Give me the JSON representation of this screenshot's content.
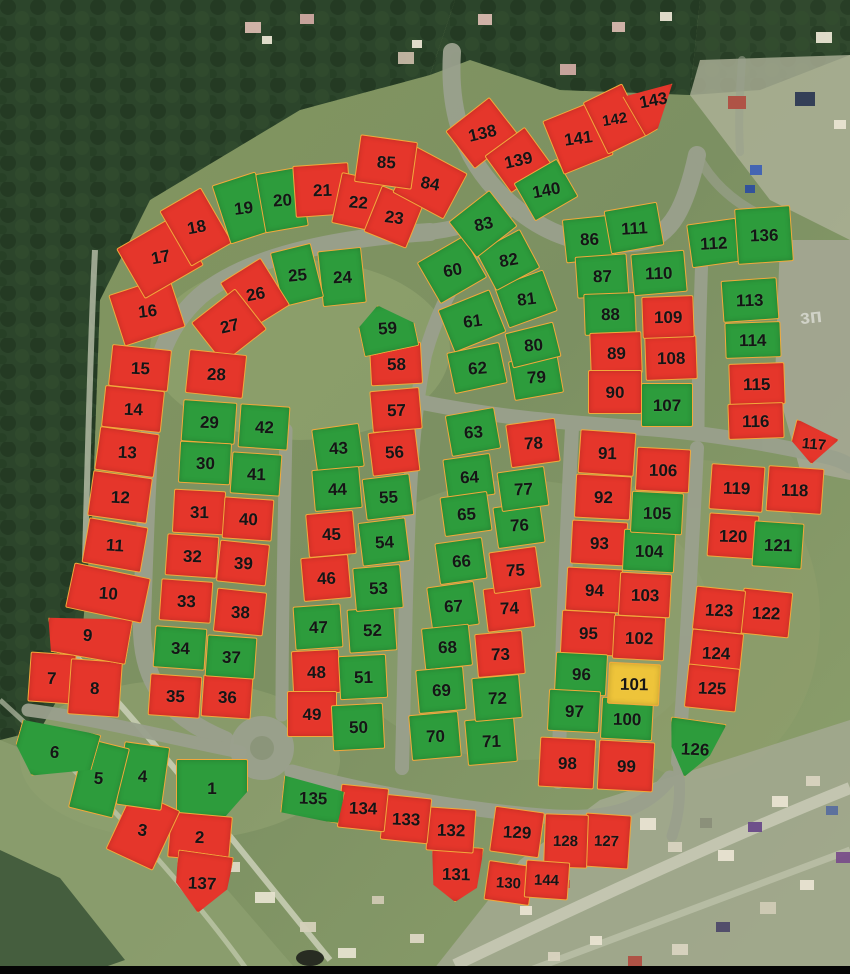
{
  "map": {
    "title": "land-plot-availability-map",
    "colors": {
      "available": "#2d9c3c",
      "sold": "#e5362b",
      "reserved": "#eec43a",
      "plot_border": "#f2a93b",
      "number_text": "#151515"
    },
    "status_codes": {
      "a": "available",
      "s": "sold",
      "v": "reserved"
    },
    "plot_fields": [
      "number",
      "cx",
      "cy",
      "w",
      "h",
      "rotation_deg",
      "status",
      "shape"
    ],
    "background_label": "зп",
    "plots": [
      [
        "1",
        212,
        788,
        72,
        58,
        0,
        "a",
        "s1"
      ],
      [
        "2",
        200,
        837,
        62,
        46,
        5,
        "s",
        ""
      ],
      [
        "3",
        143,
        830,
        52,
        66,
        25,
        "s",
        ""
      ],
      [
        "4",
        143,
        776,
        46,
        64,
        8,
        "a",
        ""
      ],
      [
        "5",
        99,
        778,
        46,
        72,
        14,
        "a",
        ""
      ],
      [
        "6",
        55,
        752,
        80,
        58,
        16,
        "a",
        "s6"
      ],
      [
        "7",
        52,
        678,
        46,
        50,
        4,
        "s",
        ""
      ],
      [
        "8",
        95,
        688,
        52,
        56,
        4,
        "s",
        ""
      ],
      [
        "9",
        88,
        635,
        84,
        46,
        10,
        "s",
        "s9"
      ],
      [
        "10",
        108,
        593,
        78,
        46,
        12,
        "s",
        ""
      ],
      [
        "11",
        115,
        545,
        60,
        46,
        10,
        "s",
        ""
      ],
      [
        "12",
        120,
        497,
        60,
        46,
        8,
        "s",
        ""
      ],
      [
        "13",
        127,
        452,
        60,
        44,
        8,
        "s",
        ""
      ],
      [
        "14",
        133,
        409,
        60,
        42,
        6,
        "s",
        ""
      ],
      [
        "15",
        140,
        368,
        60,
        42,
        6,
        "s",
        ""
      ],
      [
        "16",
        147,
        311,
        64,
        54,
        -18,
        "s",
        ""
      ],
      [
        "17",
        160,
        257,
        68,
        58,
        -30,
        "s",
        ""
      ],
      [
        "18",
        196,
        227,
        48,
        64,
        -30,
        "s",
        ""
      ],
      [
        "19",
        243,
        208,
        46,
        62,
        -18,
        "a",
        ""
      ],
      [
        "20",
        282,
        200,
        44,
        60,
        -10,
        "a",
        ""
      ],
      [
        "21",
        322,
        190,
        56,
        52,
        -4,
        "s",
        ""
      ],
      [
        "22",
        358,
        202,
        44,
        52,
        12,
        "s",
        ""
      ],
      [
        "23",
        394,
        217,
        46,
        50,
        22,
        "s",
        ""
      ],
      [
        "24",
        342,
        277,
        44,
        56,
        -6,
        "a",
        ""
      ],
      [
        "25",
        297,
        275,
        42,
        56,
        -14,
        "a",
        ""
      ],
      [
        "26",
        255,
        294,
        48,
        56,
        -32,
        "s",
        ""
      ],
      [
        "27",
        229,
        326,
        56,
        52,
        -38,
        "s",
        ""
      ],
      [
        "28",
        216,
        374,
        58,
        44,
        6,
        "s",
        ""
      ],
      [
        "29",
        209,
        422,
        54,
        42,
        4,
        "a",
        ""
      ],
      [
        "30",
        205,
        463,
        52,
        42,
        3,
        "a",
        ""
      ],
      [
        "31",
        199,
        512,
        52,
        44,
        3,
        "s",
        ""
      ],
      [
        "32",
        192,
        556,
        52,
        42,
        4,
        "s",
        ""
      ],
      [
        "33",
        186,
        601,
        52,
        42,
        4,
        "s",
        ""
      ],
      [
        "34",
        180,
        648,
        52,
        42,
        4,
        "a",
        ""
      ],
      [
        "35",
        175,
        696,
        52,
        42,
        4,
        "s",
        ""
      ],
      [
        "36",
        227,
        697,
        50,
        42,
        4,
        "s",
        ""
      ],
      [
        "37",
        231,
        657,
        50,
        42,
        4,
        "a",
        ""
      ],
      [
        "38",
        240,
        612,
        50,
        44,
        6,
        "s",
        ""
      ],
      [
        "39",
        243,
        563,
        50,
        42,
        6,
        "s",
        ""
      ],
      [
        "40",
        248,
        519,
        50,
        42,
        4,
        "s",
        ""
      ],
      [
        "41",
        256,
        474,
        50,
        42,
        4,
        "a",
        ""
      ],
      [
        "42",
        264,
        427,
        50,
        44,
        4,
        "a",
        ""
      ],
      [
        "43",
        338,
        448,
        48,
        44,
        -8,
        "a",
        ""
      ],
      [
        "44",
        337,
        489,
        48,
        42,
        -5,
        "a",
        ""
      ],
      [
        "45",
        331,
        534,
        48,
        44,
        -5,
        "s",
        ""
      ],
      [
        "46",
        326,
        578,
        48,
        44,
        -5,
        "s",
        ""
      ],
      [
        "47",
        318,
        627,
        48,
        44,
        -4,
        "a",
        ""
      ],
      [
        "48",
        316,
        672,
        48,
        44,
        -3,
        "s",
        ""
      ],
      [
        "49",
        312,
        714,
        50,
        46,
        0,
        "s",
        ""
      ],
      [
        "50",
        358,
        727,
        52,
        46,
        -3,
        "a",
        ""
      ],
      [
        "51",
        363,
        677,
        48,
        44,
        -3,
        "a",
        ""
      ],
      [
        "52",
        372,
        630,
        48,
        44,
        -4,
        "a",
        ""
      ],
      [
        "53",
        378,
        588,
        48,
        44,
        -5,
        "a",
        ""
      ],
      [
        "54",
        384,
        542,
        48,
        44,
        -7,
        "a",
        ""
      ],
      [
        "55",
        388,
        497,
        48,
        42,
        -7,
        "a",
        ""
      ],
      [
        "56",
        394,
        452,
        48,
        44,
        -7,
        "s",
        ""
      ],
      [
        "57",
        396,
        410,
        50,
        42,
        -5,
        "s",
        ""
      ],
      [
        "58",
        396,
        364,
        52,
        42,
        -3,
        "s",
        ""
      ],
      [
        "59",
        387,
        328,
        56,
        48,
        -12,
        "a",
        "s59"
      ],
      [
        "60",
        452,
        270,
        54,
        48,
        -30,
        "a",
        ""
      ],
      [
        "61",
        472,
        321,
        56,
        46,
        -22,
        "a",
        ""
      ],
      [
        "62",
        477,
        368,
        54,
        42,
        -12,
        "a",
        ""
      ],
      [
        "63",
        473,
        432,
        50,
        42,
        -10,
        "a",
        ""
      ],
      [
        "64",
        469,
        477,
        48,
        42,
        -8,
        "a",
        ""
      ],
      [
        "65",
        466,
        514,
        48,
        40,
        -8,
        "a",
        ""
      ],
      [
        "66",
        461,
        561,
        48,
        42,
        -8,
        "a",
        ""
      ],
      [
        "67",
        453,
        606,
        48,
        44,
        -8,
        "a",
        ""
      ],
      [
        "68",
        447,
        647,
        48,
        42,
        -6,
        "a",
        ""
      ],
      [
        "69",
        441,
        690,
        48,
        44,
        -5,
        "a",
        ""
      ],
      [
        "70",
        435,
        736,
        50,
        46,
        -5,
        "a",
        ""
      ],
      [
        "71",
        491,
        741,
        50,
        46,
        -5,
        "a",
        ""
      ],
      [
        "72",
        497,
        698,
        48,
        44,
        -5,
        "a",
        ""
      ],
      [
        "73",
        500,
        654,
        48,
        44,
        -5,
        "s",
        ""
      ],
      [
        "74",
        509,
        608,
        48,
        44,
        -7,
        "s",
        ""
      ],
      [
        "75",
        515,
        570,
        48,
        42,
        -8,
        "s",
        ""
      ],
      [
        "76",
        519,
        525,
        48,
        42,
        -8,
        "a",
        ""
      ],
      [
        "77",
        523,
        489,
        48,
        40,
        -8,
        "a",
        ""
      ],
      [
        "78",
        533,
        443,
        50,
        44,
        -8,
        "s",
        ""
      ],
      [
        "79",
        536,
        377,
        50,
        40,
        -10,
        "a",
        ""
      ],
      [
        "80",
        533,
        345,
        50,
        36,
        -14,
        "a",
        ""
      ],
      [
        "81",
        526,
        299,
        52,
        44,
        -20,
        "a",
        ""
      ],
      [
        "82",
        508,
        260,
        50,
        44,
        -28,
        "a",
        ""
      ],
      [
        "83",
        483,
        224,
        52,
        46,
        -38,
        "a",
        ""
      ],
      [
        "84",
        430,
        183,
        58,
        52,
        28,
        "s",
        ""
      ],
      [
        "85",
        386,
        162,
        58,
        48,
        8,
        "s",
        ""
      ],
      [
        "86",
        589,
        239,
        50,
        44,
        -6,
        "a",
        ""
      ],
      [
        "87",
        602,
        276,
        52,
        42,
        -4,
        "a",
        ""
      ],
      [
        "88",
        610,
        314,
        52,
        42,
        -2,
        "a",
        ""
      ],
      [
        "89",
        616,
        353,
        52,
        42,
        -2,
        "s",
        ""
      ],
      [
        "90",
        615,
        392,
        54,
        44,
        0,
        "s",
        ""
      ],
      [
        "91",
        607,
        453,
        56,
        44,
        4,
        "s",
        ""
      ],
      [
        "92",
        603,
        497,
        56,
        44,
        3,
        "s",
        ""
      ],
      [
        "93",
        599,
        543,
        56,
        44,
        3,
        "s",
        ""
      ],
      [
        "94",
        594,
        590,
        56,
        44,
        3,
        "s",
        ""
      ],
      [
        "95",
        588,
        633,
        54,
        44,
        3,
        "s",
        ""
      ],
      [
        "96",
        581,
        674,
        52,
        42,
        3,
        "a",
        ""
      ],
      [
        "97",
        574,
        711,
        52,
        42,
        3,
        "a",
        ""
      ],
      [
        "98",
        567,
        763,
        56,
        50,
        3,
        "s",
        ""
      ],
      [
        "99",
        626,
        766,
        56,
        50,
        3,
        "s",
        ""
      ],
      [
        "100",
        627,
        719,
        52,
        42,
        3,
        "a",
        ""
      ],
      [
        "101",
        634,
        684,
        52,
        42,
        3,
        "v",
        ""
      ],
      [
        "102",
        639,
        638,
        52,
        44,
        3,
        "s",
        ""
      ],
      [
        "103",
        645,
        595,
        52,
        44,
        3,
        "s",
        ""
      ],
      [
        "104",
        649,
        551,
        52,
        42,
        3,
        "a",
        ""
      ],
      [
        "105",
        657,
        513,
        52,
        42,
        3,
        "a",
        ""
      ],
      [
        "106",
        663,
        470,
        54,
        44,
        3,
        "s",
        ""
      ],
      [
        "107",
        667,
        405,
        52,
        44,
        0,
        "a",
        ""
      ],
      [
        "108",
        671,
        358,
        52,
        44,
        -2,
        "s",
        ""
      ],
      [
        "109",
        668,
        317,
        52,
        42,
        -2,
        "s",
        ""
      ],
      [
        "110",
        659,
        273,
        54,
        42,
        -5,
        "a",
        ""
      ],
      [
        "111",
        634,
        228,
        54,
        44,
        -10,
        "a",
        ""
      ],
      [
        "112",
        714,
        243,
        50,
        44,
        -8,
        "a",
        ""
      ],
      [
        "113",
        750,
        300,
        56,
        42,
        -4,
        "a",
        ""
      ],
      [
        "114",
        753,
        340,
        56,
        36,
        -2,
        "a",
        ""
      ],
      [
        "115",
        757,
        384,
        56,
        42,
        -2,
        "s",
        ""
      ],
      [
        "116",
        756,
        421,
        56,
        36,
        -2,
        "s",
        ""
      ],
      [
        "117",
        814,
        444,
        46,
        40,
        14,
        "s",
        "s117"
      ],
      [
        "118",
        795,
        490,
        56,
        46,
        4,
        "s",
        ""
      ],
      [
        "119",
        737,
        488,
        54,
        46,
        4,
        "s",
        ""
      ],
      [
        "120",
        733,
        536,
        50,
        44,
        4,
        "s",
        ""
      ],
      [
        "121",
        778,
        545,
        50,
        46,
        4,
        "a",
        ""
      ],
      [
        "122",
        766,
        613,
        50,
        46,
        6,
        "s",
        ""
      ],
      [
        "123",
        719,
        610,
        50,
        44,
        6,
        "s",
        ""
      ],
      [
        "124",
        716,
        653,
        52,
        44,
        6,
        "s",
        ""
      ],
      [
        "125",
        712,
        688,
        52,
        44,
        6,
        "s",
        ""
      ],
      [
        "126",
        695,
        749,
        56,
        58,
        8,
        "a",
        "s126"
      ],
      [
        "127",
        607,
        841,
        46,
        54,
        4,
        "s",
        ""
      ],
      [
        "128",
        566,
        841,
        44,
        54,
        2,
        "s",
        ""
      ],
      [
        "129",
        517,
        832,
        50,
        46,
        8,
        "s",
        ""
      ],
      [
        "130",
        509,
        883,
        46,
        40,
        8,
        "s",
        ""
      ],
      [
        "131",
        456,
        874,
        52,
        56,
        4,
        "s",
        "s131"
      ],
      [
        "132",
        451,
        830,
        48,
        44,
        4,
        "s",
        ""
      ],
      [
        "133",
        406,
        819,
        48,
        46,
        6,
        "s",
        ""
      ],
      [
        "134",
        363,
        808,
        48,
        44,
        6,
        "s",
        ""
      ],
      [
        "135",
        313,
        798,
        62,
        46,
        6,
        "a",
        "s135"
      ],
      [
        "136",
        764,
        235,
        56,
        56,
        -4,
        "a",
        ""
      ],
      [
        "137",
        202,
        883,
        56,
        60,
        8,
        "s",
        "s137"
      ],
      [
        "138",
        482,
        133,
        56,
        48,
        -38,
        "s",
        ""
      ],
      [
        "139",
        518,
        160,
        50,
        46,
        -36,
        "s",
        ""
      ],
      [
        "140",
        546,
        190,
        50,
        44,
        -30,
        "a",
        ""
      ],
      [
        "141",
        578,
        138,
        54,
        58,
        -22,
        "s",
        ""
      ],
      [
        "142",
        615,
        119,
        44,
        58,
        -26,
        "s",
        ""
      ],
      [
        "143",
        653,
        100,
        50,
        56,
        -30,
        "s",
        "s143"
      ],
      [
        "144",
        547,
        880,
        44,
        38,
        4,
        "s",
        ""
      ]
    ]
  }
}
